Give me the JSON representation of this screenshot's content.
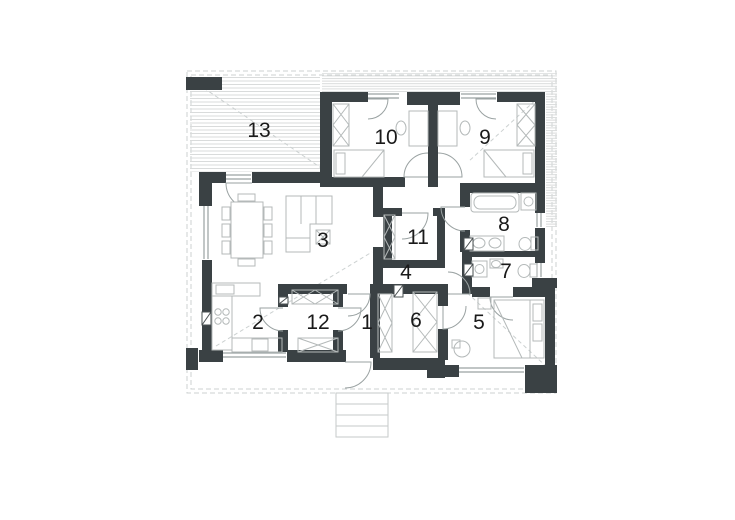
{
  "plan": {
    "type": "single-storey house floor plan",
    "rooms": [
      {
        "number": "1",
        "x": 367,
        "y": 329
      },
      {
        "number": "2",
        "x": 258,
        "y": 329
      },
      {
        "number": "3",
        "x": 323,
        "y": 247
      },
      {
        "number": "4",
        "x": 406,
        "y": 279
      },
      {
        "number": "5",
        "x": 479,
        "y": 329
      },
      {
        "number": "6",
        "x": 416,
        "y": 327
      },
      {
        "number": "7",
        "x": 506,
        "y": 278
      },
      {
        "number": "8",
        "x": 504,
        "y": 231
      },
      {
        "number": "9",
        "x": 485,
        "y": 144
      },
      {
        "number": "10",
        "x": 386,
        "y": 144
      },
      {
        "number": "11",
        "x": 418,
        "y": 244
      },
      {
        "number": "12",
        "x": 318,
        "y": 329
      },
      {
        "number": "13",
        "x": 259,
        "y": 137
      }
    ]
  },
  "colors": {
    "wall": "#3a4144",
    "opening": "#9aa2a2",
    "furniture": "#b4b9b9",
    "hatch": "#d9dbdb",
    "eaves": "#ccd1d1",
    "label": "#1a1a1a"
  }
}
